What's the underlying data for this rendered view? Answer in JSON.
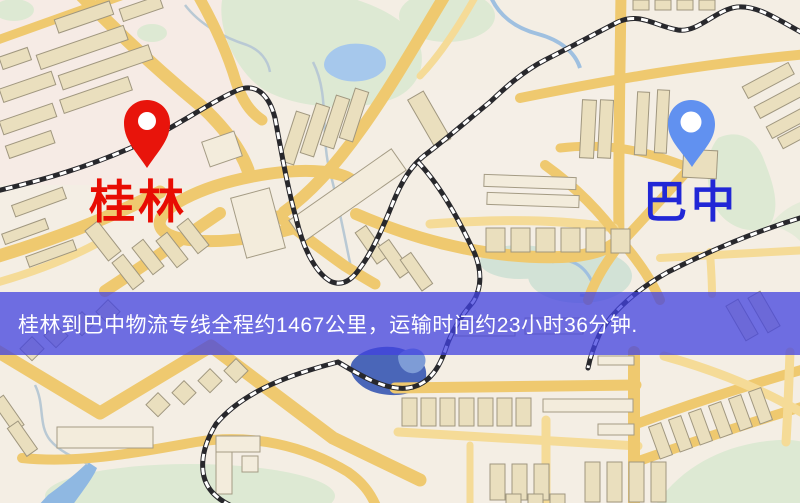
{
  "banner": {
    "text": "桂林到巴中物流专线全程约1467公里，运输时间约23小时36分钟.",
    "background_color": "#4242e0",
    "text_color": "#ffffff"
  },
  "markers": {
    "origin": {
      "label": "桂林",
      "pin_color": "#e8140b",
      "label_color": "#e80c03"
    },
    "destination": {
      "label": "巴中",
      "pin_color": "#6191f0",
      "label_color": "#2127d6"
    }
  },
  "route": {
    "from": "桂林",
    "to": "巴中",
    "distance_text": "约1467公里",
    "duration_text": "约23小时36分钟"
  }
}
